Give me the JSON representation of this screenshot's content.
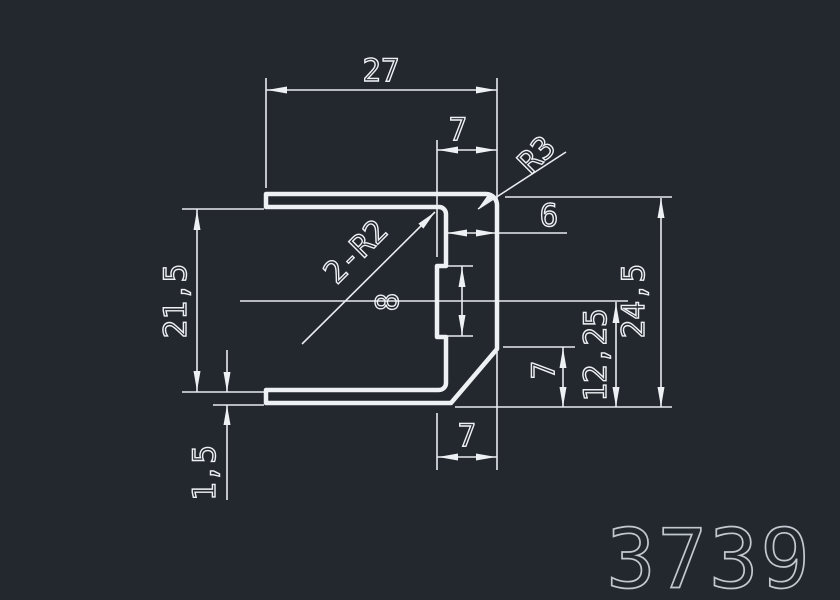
{
  "drawing": {
    "part_number": "3739",
    "colors": {
      "background": "#23272e",
      "line": "#eef1f4",
      "part_number": "#c2c8d0"
    },
    "dimensions": {
      "overall_width": "27",
      "top_web_width": "7",
      "outer_corner_radius": "R3",
      "web_thickness": "6",
      "inner_fillet_radii": "2-R2",
      "notch_height": "8",
      "inner_height": "21,5",
      "overall_height": "24,5",
      "centerline_to_bottom": "12,25",
      "chamfer_vertical": "7",
      "chamfer_horizontal": "7",
      "wall_thickness": "1,5"
    }
  }
}
